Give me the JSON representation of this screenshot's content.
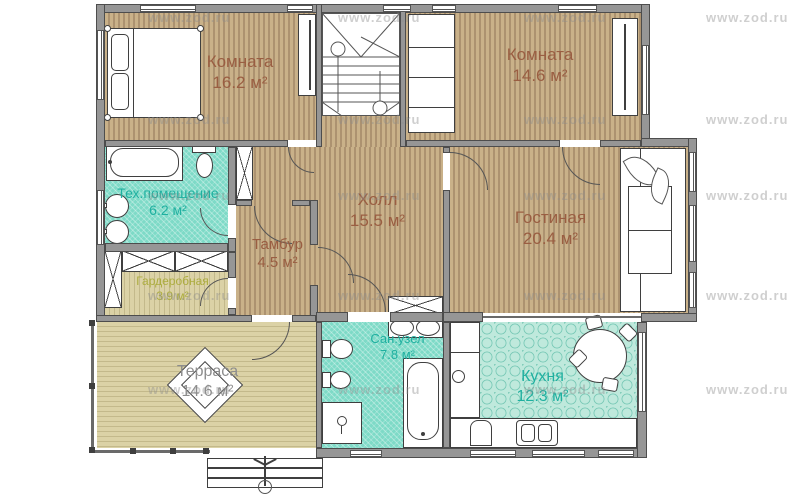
{
  "watermark": {
    "text": "www.zod.ru"
  },
  "rooms": {
    "bedroom1": {
      "name": "Комната",
      "area": "16.2 м²"
    },
    "bedroom2": {
      "name": "Комната",
      "area": "14.6 м²"
    },
    "tech": {
      "name": "Тех.помещение",
      "area": "6.2 м²"
    },
    "tambour": {
      "name": "Тамбур",
      "area": "4.5 м²"
    },
    "hall": {
      "name": "Холл",
      "area": "15.5 м²"
    },
    "living": {
      "name": "Гостиная",
      "area": "20.4 м²"
    },
    "wardrobe": {
      "name": "Гардеробная",
      "area": "3.9 м²"
    },
    "terrace": {
      "name": "Терраса",
      "area": "14.6 м²"
    },
    "bathroom": {
      "name": "Сан.узел",
      "area": "7.8 м²"
    },
    "kitchen": {
      "name": "Кухня",
      "area": "12.3 м²"
    }
  },
  "colors": {
    "wood": "#c9b189",
    "teal": "#7edac7",
    "khaki": "#dbd2a6",
    "tile": "#bfe9dc",
    "wall": "#969696",
    "label_brown": "#9a5e42",
    "label_teal": "#1fb0a0",
    "label_olive": "#adad3f",
    "label_gray": "#8d8d8d"
  }
}
